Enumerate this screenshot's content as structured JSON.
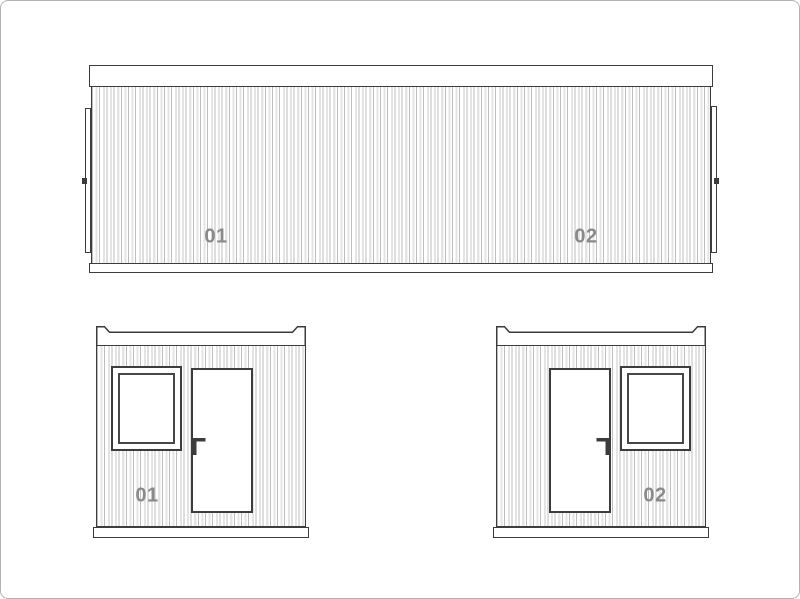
{
  "page": {
    "title": "Container module elevations drawing",
    "background": "#ffffff",
    "frame_border_color": "#b3b3b3"
  },
  "drawing": {
    "line_color": "#3c3c3c",
    "corrugation_line_color": "#bdbdbd",
    "corrugation_light_color": "#e4e4e4",
    "label_color": "#8a8a8a",
    "side_elevation": {
      "description": "long side elevation of joined container modules",
      "module_left_label": "01",
      "module_right_label": "02"
    },
    "end_elevation_left": {
      "description": "end elevation, window left / door right",
      "module_label": "01"
    },
    "end_elevation_right": {
      "description": "end elevation, door left / window right",
      "module_label": "02"
    }
  }
}
